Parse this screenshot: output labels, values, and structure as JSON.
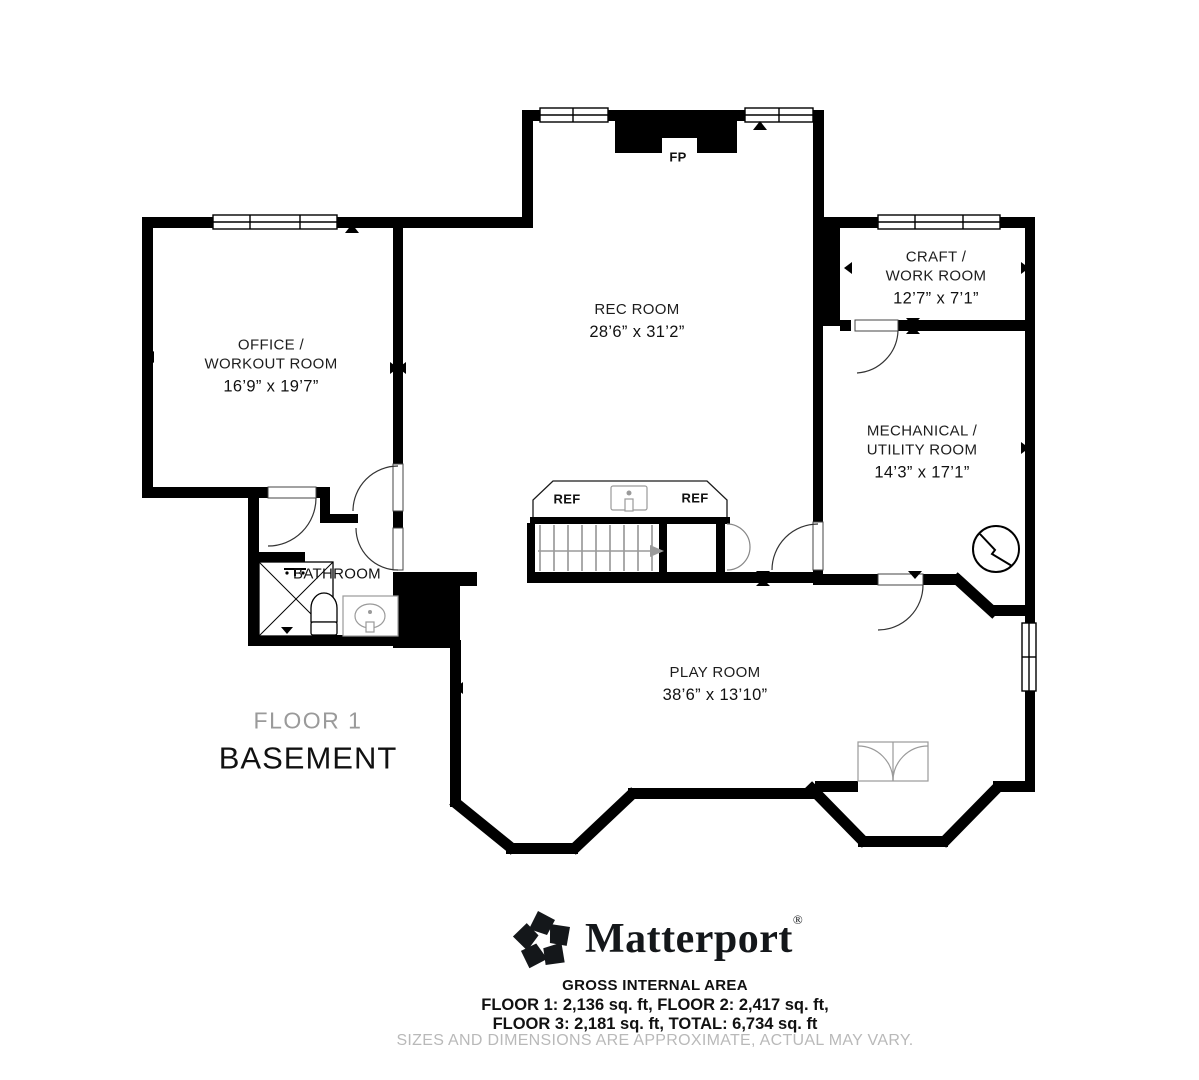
{
  "plan": {
    "floor_label": "FLOOR 1",
    "floor_name": "BASEMENT",
    "rooms": [
      {
        "id": "office",
        "name_lines": [
          "OFFICE /",
          "WORKOUT ROOM"
        ],
        "dimensions": "16’9” x 19’7”"
      },
      {
        "id": "rec",
        "name_lines": [
          "REC ROOM"
        ],
        "dimensions": "28’6” x 31’2”"
      },
      {
        "id": "craft",
        "name_lines": [
          "CRAFT /",
          "WORK ROOM"
        ],
        "dimensions": "12’7” x 7’1”"
      },
      {
        "id": "mechanical",
        "name_lines": [
          "MECHANICAL /",
          "UTILITY ROOM"
        ],
        "dimensions": "14’3” x 17’1”"
      },
      {
        "id": "bathroom",
        "name_lines": [
          "BATHROOM"
        ],
        "dimensions": ""
      },
      {
        "id": "play",
        "name_lines": [
          "PLAY ROOM"
        ],
        "dimensions": "38’6” x 13’10”"
      }
    ],
    "annotations": {
      "fireplace": "FP",
      "fridge_left": "REF",
      "fridge_right": "REF"
    }
  },
  "footer": {
    "brand": "Matterport",
    "registered": "®",
    "area_title": "GROSS INTERNAL AREA",
    "area_line1": "FLOOR 1: 2,136 sq. ft, FLOOR 2: 2,417 sq. ft,",
    "area_line2": "FLOOR 3: 2,181 sq. ft, TOTAL: 6,734 sq. ft",
    "disclaimer": "SIZES AND DIMENSIONS ARE APPROXIMATE, ACTUAL MAY VARY."
  },
  "colors": {
    "wall": "#000000",
    "label": "#1d1d1d",
    "floor_muted": "#9a9a9a",
    "disclaimer": "#b9b9b9",
    "fixture_stroke": "#9a9a9a"
  }
}
